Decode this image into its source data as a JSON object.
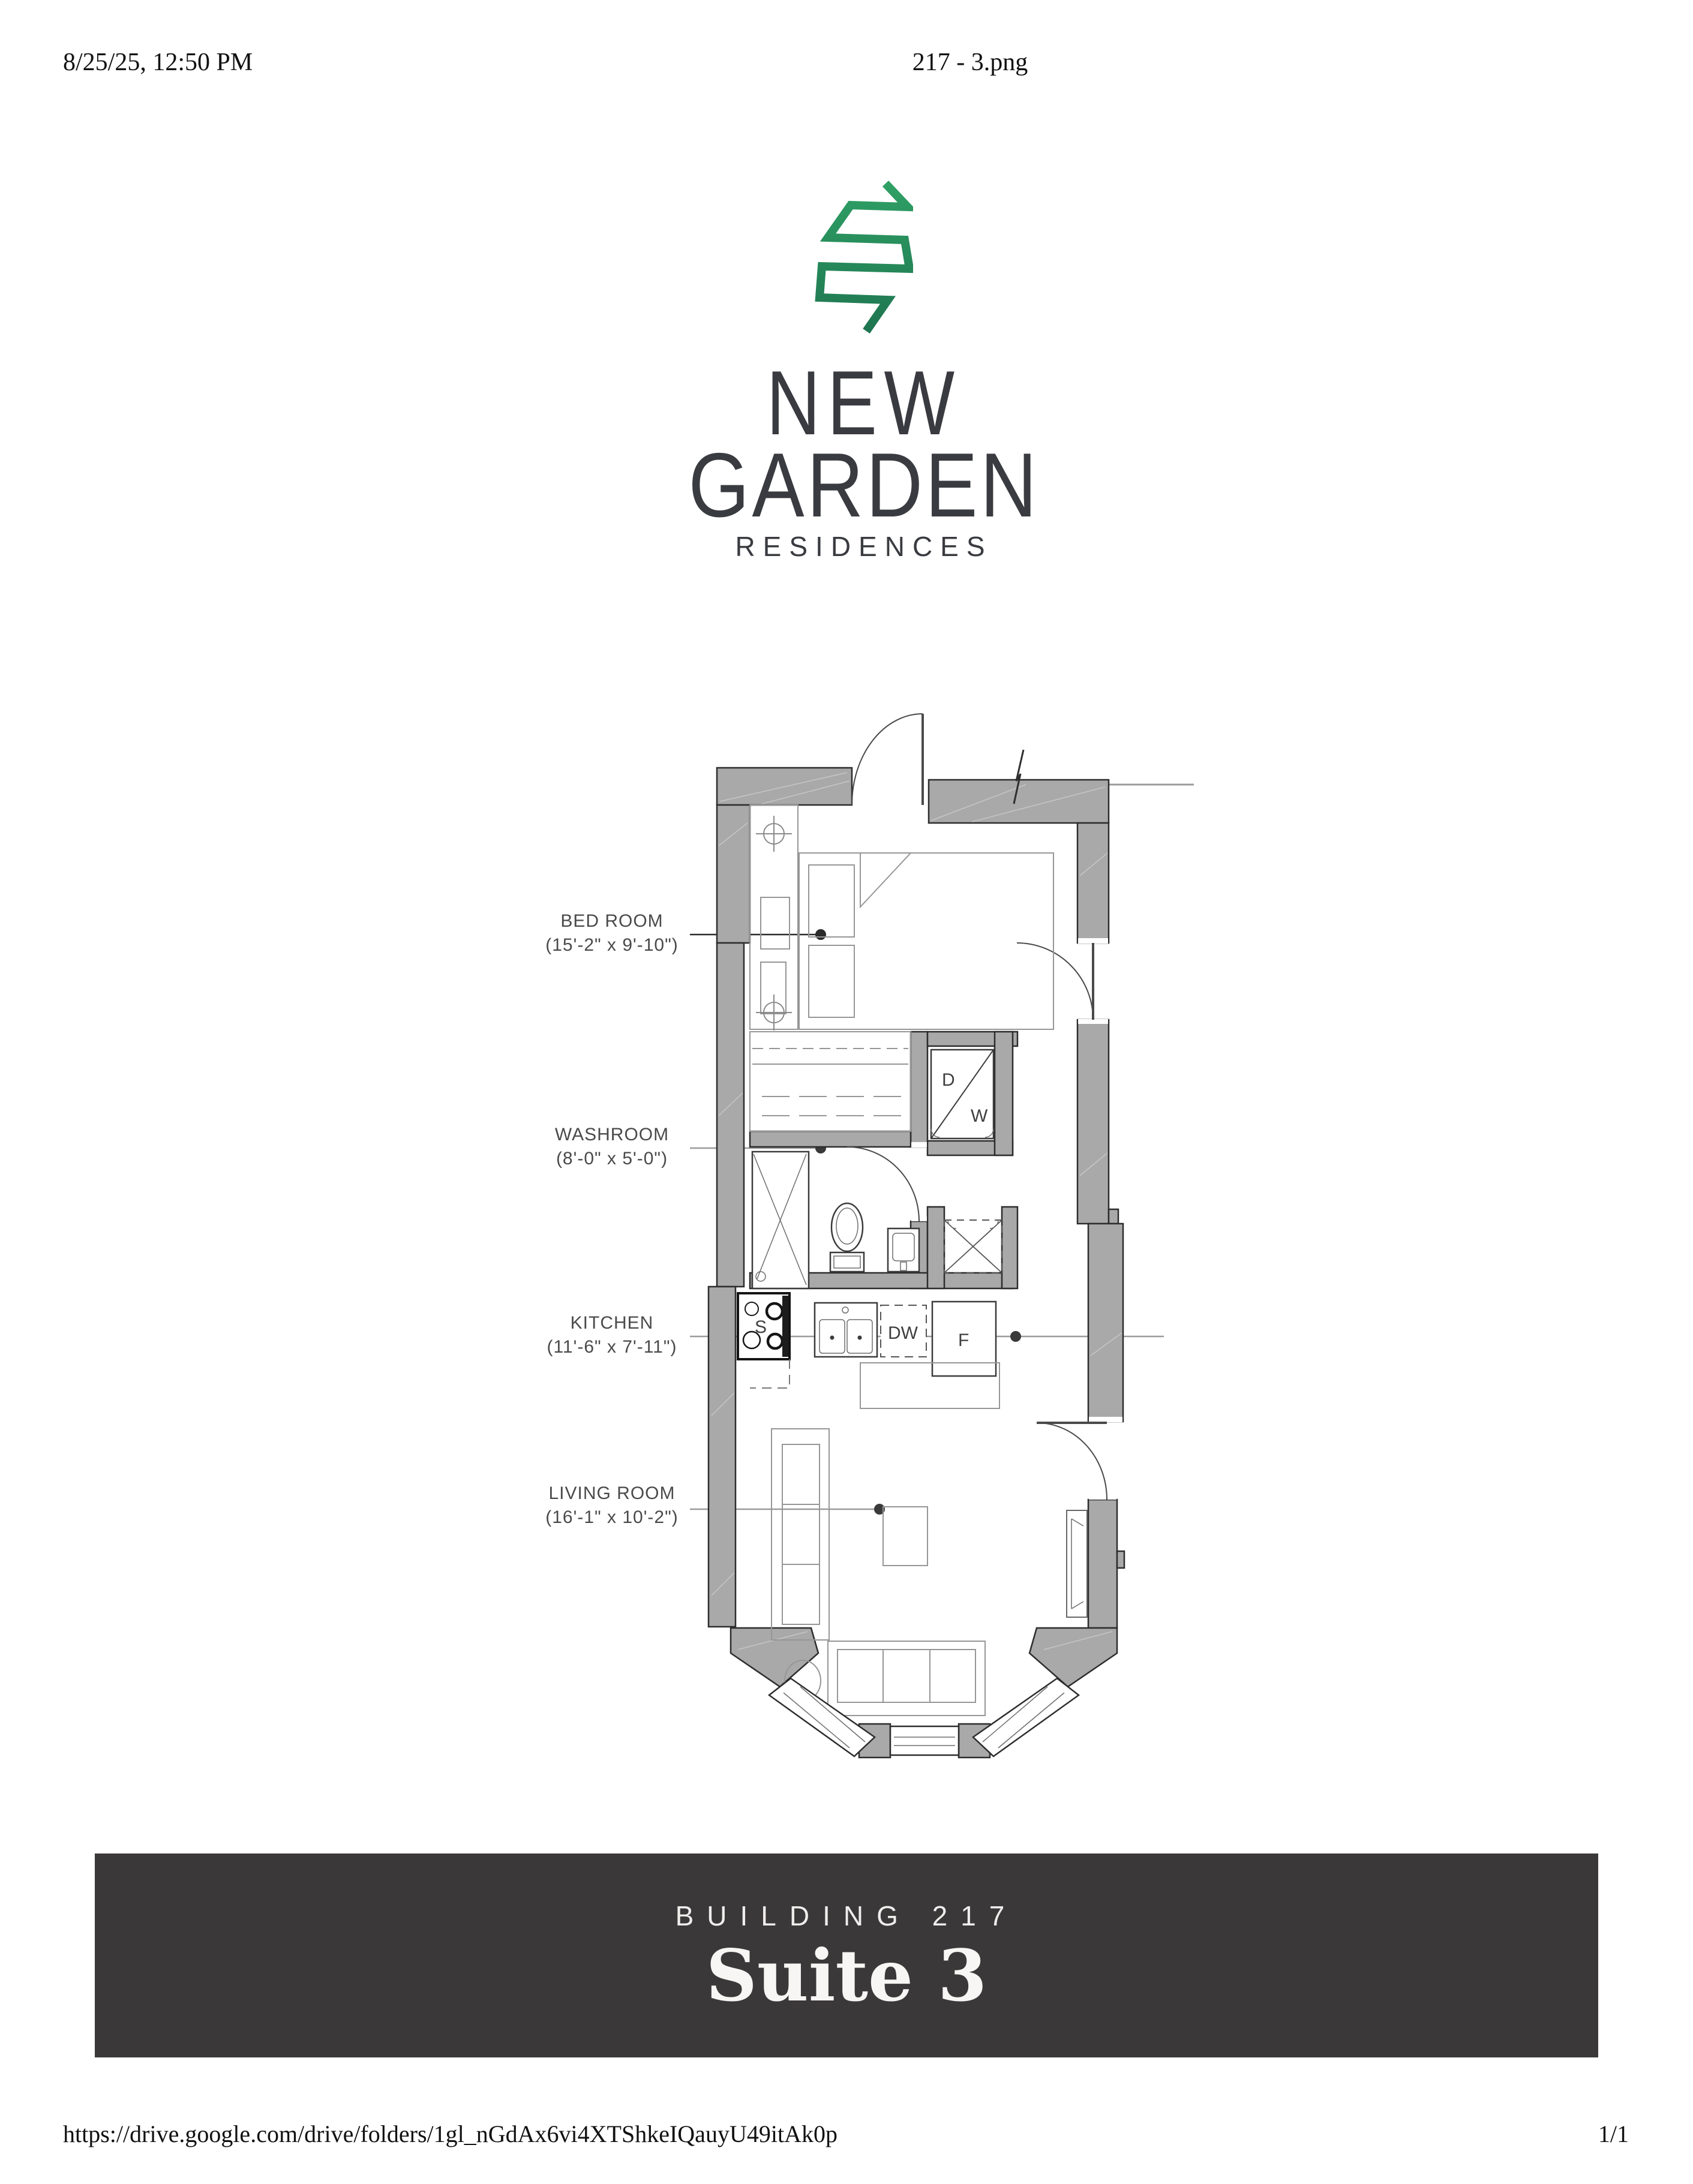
{
  "header": {
    "date": "8/25/25, 12:50 PM",
    "filename": "217 - 3.png"
  },
  "logo": {
    "icon": "leaf-zigzag-icon",
    "line1": "NEW",
    "line2": "GARDEN",
    "line3": "RESIDENCES"
  },
  "floor_plan": {
    "rooms": [
      {
        "name": "BED ROOM",
        "dims": "(15'-2\" x 9'-10\")"
      },
      {
        "name": "WASHROOM",
        "dims": "(8'-0\" x 5'-0\")"
      },
      {
        "name": "KITCHEN",
        "dims": "(11'-6\" x 7'-11\")"
      },
      {
        "name": "LIVING ROOM",
        "dims": "(16'-1\" x 10'-2\")"
      }
    ],
    "appliances": {
      "dryer": "D",
      "washer": "W",
      "dishwasher": "DW",
      "fridge": "F",
      "stove": "S"
    }
  },
  "banner": {
    "building": "BUILDING 217",
    "suite": "Suite 3"
  },
  "footer": {
    "url": "https://drive.google.com/drive/folders/1gl_nGdAx6vi4XTShkeIQauyU49itAk0p",
    "page": "1/1"
  },
  "colors": {
    "brand_green_top": "#2fa065",
    "brand_green_bottom": "#1e7550",
    "banner_bg": "#3b3839",
    "logo_text": "#393b40",
    "wall_fill": "#a9a9a9"
  }
}
